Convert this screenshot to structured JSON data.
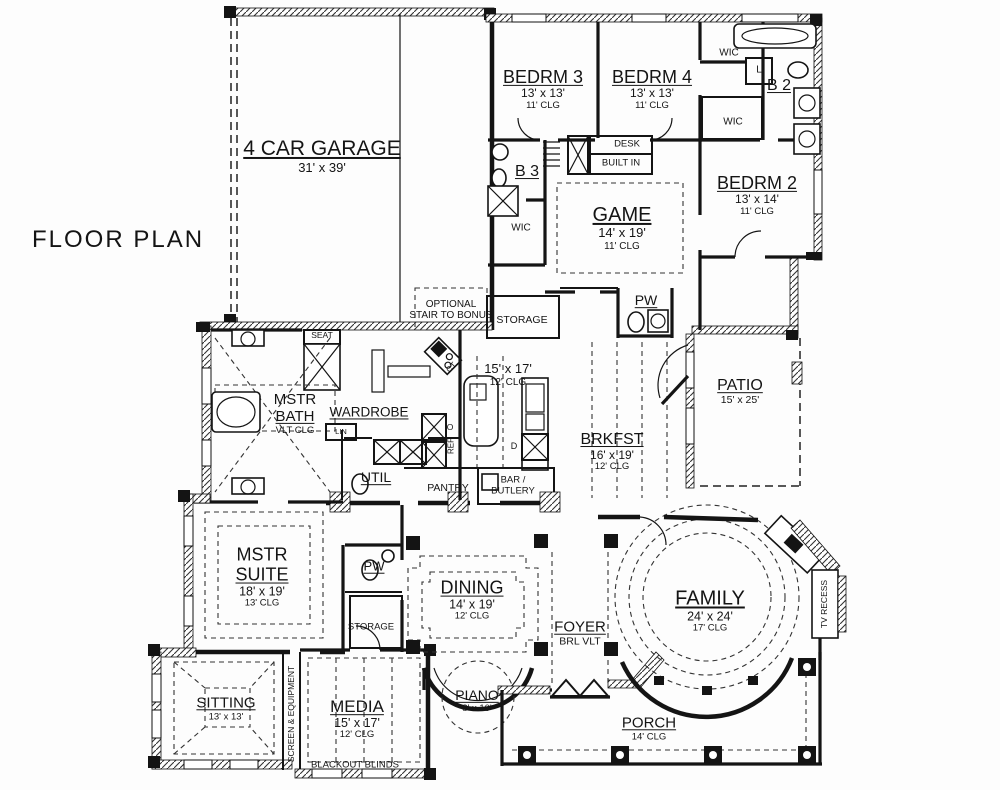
{
  "title": "FLOOR PLAN",
  "rooms": {
    "garage": {
      "name": "4 CAR GARAGE",
      "size": "31' x 39'"
    },
    "bedrm3": {
      "name": "BEDRM 3",
      "size": "13' x 13'",
      "clg": "11' CLG"
    },
    "bedrm4": {
      "name": "BEDRM 4",
      "size": "13' x 13'",
      "clg": "11' CLG"
    },
    "bedrm2": {
      "name": "BEDRM 2",
      "size": "13' x 14'",
      "clg": "11' CLG"
    },
    "b2": {
      "name": "B 2"
    },
    "b3": {
      "name": "B 3"
    },
    "game": {
      "name": "GAME",
      "size": "14' x 19'",
      "clg": "11' CLG"
    },
    "pw": {
      "name": "PW"
    },
    "patio": {
      "name": "PATIO",
      "size": "15' x 25'"
    },
    "mstr_bath": {
      "name1": "MSTR",
      "name2": "BATH",
      "clg": "VLT CLG"
    },
    "wardrobe": {
      "name": "WARDROBE"
    },
    "util": {
      "name": "UTIL"
    },
    "kitchen": {
      "size": "15' x 17'",
      "clg": "12' CLG"
    },
    "brkfst": {
      "name": "BRKFST",
      "size": "16' x 19'",
      "clg": "12' CLG"
    },
    "mstr_suite": {
      "name1": "MSTR",
      "name2": "SUITE",
      "size": "18' x 19'",
      "clg": "13' CLG"
    },
    "dining": {
      "name": "DINING",
      "size": "14' x 19'",
      "clg": "12' CLG"
    },
    "foyer": {
      "name": "FOYER",
      "clg": "BRL VLT"
    },
    "family": {
      "name": "FAMILY",
      "size": "24' x 24'",
      "clg": "17' CLG"
    },
    "piano": {
      "name": "PIANO",
      "size": "8' x 10'"
    },
    "sitting": {
      "name": "SITTING",
      "size": "13' x 13'"
    },
    "media": {
      "name": "MEDIA",
      "size": "15' x 17'",
      "clg": "12' CLG"
    },
    "porch": {
      "name": "PORCH",
      "clg": "14' CLG"
    }
  },
  "annotations": {
    "wic": "WIC",
    "l": "L",
    "seat": "SEAT",
    "lin": "LIN",
    "desk": "DESK",
    "built_in": "BUILT IN",
    "storage": "STORAGE",
    "pantry": "PANTRY",
    "bar_butler_1": "BAR /",
    "bar_butler_2": "BUTLERY",
    "ref": "REF",
    "ct": "CT",
    "d": "D",
    "o": "O",
    "optional_stair_1": "OPTIONAL",
    "optional_stair_2": "STAIR TO BONUS",
    "screen_equipment": "SCREEN & EQUIPMENT",
    "blackout_blinds": "BLACKOUT BLINDS",
    "tv_recess": "TV RECESS"
  },
  "colors": {
    "ink": "#141414",
    "paper": "#fdfdfd",
    "ceiling_dash": "#333333"
  }
}
